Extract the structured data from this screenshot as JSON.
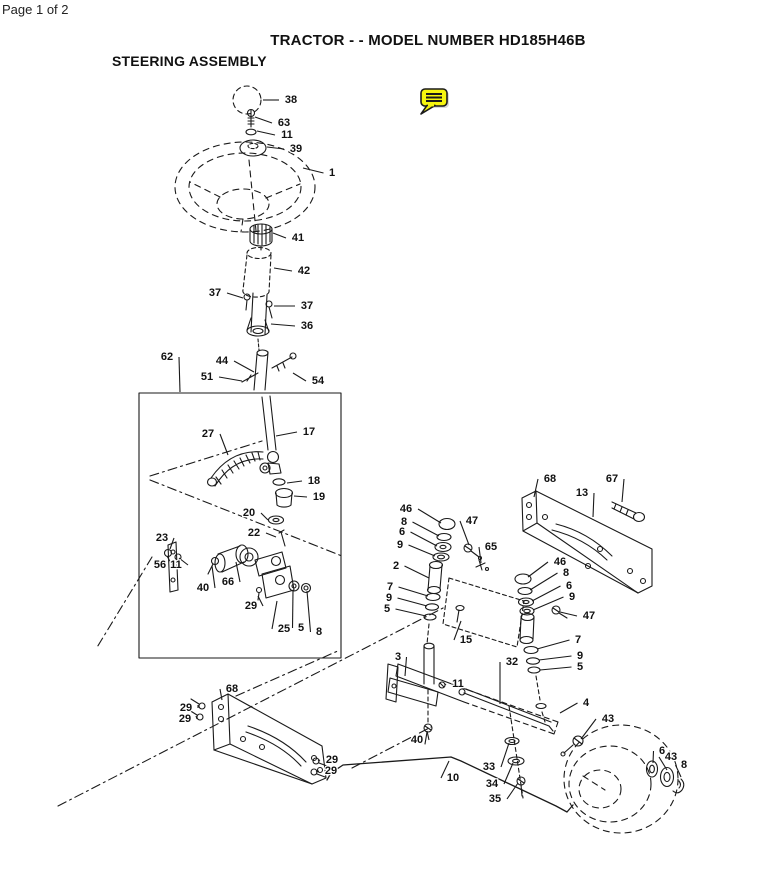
{
  "page": {
    "indicator": "Page 1 of 2"
  },
  "header": {
    "title": "TRACTOR - - MODEL NUMBER HD185H46B",
    "subtitle": "STEERING ASSEMBLY"
  },
  "annotation": {
    "icon": "comment-note",
    "color": "#f6f50e"
  },
  "diagram": {
    "description": "Exploded parts view of tractor steering assembly with numbered callouts",
    "ink": "#1a1a1a",
    "callouts": [
      {
        "n": "38",
        "x": 291,
        "y": 100,
        "tx": 263,
        "ty": 100
      },
      {
        "n": "63",
        "x": 284,
        "y": 123,
        "tx": 255,
        "ty": 117
      },
      {
        "n": "11",
        "x": 287,
        "y": 135,
        "tx": 257,
        "ty": 131
      },
      {
        "n": "39",
        "x": 296,
        "y": 149,
        "tx": 267,
        "ty": 147
      },
      {
        "n": "1",
        "x": 332,
        "y": 173,
        "tx": 303,
        "ty": 168
      },
      {
        "n": "41",
        "x": 298,
        "y": 238,
        "tx": 273,
        "ty": 233
      },
      {
        "n": "42",
        "x": 304,
        "y": 271,
        "tx": 274,
        "ty": 268
      },
      {
        "n": "37",
        "x": 215,
        "y": 293,
        "tx": 243,
        "ty": 298
      },
      {
        "n": "37",
        "x": 307,
        "y": 306,
        "tx": 274,
        "ty": 306
      },
      {
        "n": "36",
        "x": 307,
        "y": 326,
        "tx": 271,
        "ty": 324
      },
      {
        "n": "62",
        "x": 167,
        "y": 357,
        "tx": 180,
        "ty": 392
      },
      {
        "n": "44",
        "x": 222,
        "y": 361,
        "tx": 254,
        "ty": 372
      },
      {
        "n": "51",
        "x": 207,
        "y": 377,
        "tx": 242,
        "ty": 381
      },
      {
        "n": "54",
        "x": 318,
        "y": 381,
        "tx": 293,
        "ty": 373
      },
      {
        "n": "17",
        "x": 309,
        "y": 432,
        "tx": 276,
        "ty": 436
      },
      {
        "n": "27",
        "x": 208,
        "y": 434,
        "tx": 228,
        "ty": 455
      },
      {
        "n": "18",
        "x": 314,
        "y": 481,
        "tx": 287,
        "ty": 483
      },
      {
        "n": "19",
        "x": 319,
        "y": 497,
        "tx": 294,
        "ty": 496
      },
      {
        "n": "20",
        "x": 249,
        "y": 513,
        "tx": 268,
        "ty": 520
      },
      {
        "n": "22",
        "x": 254,
        "y": 533,
        "tx": 276,
        "ty": 537
      },
      {
        "n": "23",
        "x": 162,
        "y": 538,
        "tx": 170,
        "ty": 549
      },
      {
        "n": "56",
        "x": 160,
        "y": 565,
        "tx": 167,
        "ty": 556
      },
      {
        "n": "11",
        "x": 176,
        "y": 565,
        "tx": 179,
        "ty": 558
      },
      {
        "n": "40",
        "x": 203,
        "y": 588,
        "tx": 212,
        "ty": 566
      },
      {
        "n": "66",
        "x": 228,
        "y": 582,
        "tx": 236,
        "ty": 562
      },
      {
        "n": "29",
        "x": 251,
        "y": 606,
        "tx": 258,
        "ty": 596
      },
      {
        "n": "25",
        "x": 284,
        "y": 629,
        "tx": 277,
        "ty": 601
      },
      {
        "n": "5",
        "x": 301,
        "y": 628,
        "tx": 293,
        "ty": 591
      },
      {
        "n": "8",
        "x": 319,
        "y": 632,
        "tx": 307,
        "ty": 591
      },
      {
        "n": "68",
        "x": 550,
        "y": 479,
        "tx": 534,
        "ty": 497
      },
      {
        "n": "13",
        "x": 582,
        "y": 493,
        "tx": 593,
        "ty": 517
      },
      {
        "n": "67",
        "x": 612,
        "y": 479,
        "tx": 622,
        "ty": 502
      },
      {
        "n": "46",
        "x": 406,
        "y": 509,
        "tx": 441,
        "ty": 523
      },
      {
        "n": "8",
        "x": 404,
        "y": 522,
        "tx": 439,
        "ty": 536
      },
      {
        "n": "6",
        "x": 402,
        "y": 532,
        "tx": 437,
        "ty": 546
      },
      {
        "n": "9",
        "x": 400,
        "y": 545,
        "tx": 435,
        "ty": 556
      },
      {
        "n": "47",
        "x": 472,
        "y": 521,
        "tx": 469,
        "ty": 545
      },
      {
        "n": "65",
        "x": 491,
        "y": 547,
        "tx": 481,
        "ty": 563
      },
      {
        "n": "2",
        "x": 396,
        "y": 566,
        "tx": 429,
        "ty": 578
      },
      {
        "n": "7",
        "x": 390,
        "y": 587,
        "tx": 428,
        "ty": 596
      },
      {
        "n": "9",
        "x": 389,
        "y": 598,
        "tx": 427,
        "ty": 606
      },
      {
        "n": "5",
        "x": 387,
        "y": 609,
        "tx": 426,
        "ty": 616
      },
      {
        "n": "15",
        "x": 466,
        "y": 640,
        "tx": 461,
        "ty": 621
      },
      {
        "n": "46",
        "x": 560,
        "y": 562,
        "tx": 528,
        "ty": 577
      },
      {
        "n": "8",
        "x": 566,
        "y": 573,
        "tx": 530,
        "ty": 590
      },
      {
        "n": "6",
        "x": 569,
        "y": 586,
        "tx": 532,
        "ty": 601
      },
      {
        "n": "9",
        "x": 572,
        "y": 597,
        "tx": 533,
        "ty": 610
      },
      {
        "n": "47",
        "x": 589,
        "y": 616,
        "tx": 560,
        "ty": 612
      },
      {
        "n": "7",
        "x": 578,
        "y": 640,
        "tx": 537,
        "ty": 649
      },
      {
        "n": "9",
        "x": 580,
        "y": 656,
        "tx": 539,
        "ty": 660
      },
      {
        "n": "5",
        "x": 580,
        "y": 667,
        "tx": 540,
        "ty": 670
      },
      {
        "n": "3",
        "x": 398,
        "y": 657,
        "tx": 405,
        "ty": 676
      },
      {
        "n": "32",
        "x": 512,
        "y": 662,
        "tx": 500,
        "ty": 704
      },
      {
        "n": "11",
        "x": 458,
        "y": 684,
        "tx": 445,
        "ty": 685
      },
      {
        "n": "4",
        "x": 586,
        "y": 703,
        "tx": 560,
        "ty": 713
      },
      {
        "n": "43",
        "x": 608,
        "y": 719,
        "tx": 581,
        "ty": 739
      },
      {
        "n": "68",
        "x": 232,
        "y": 689,
        "tx": 222,
        "ty": 700
      },
      {
        "n": "29",
        "x": 186,
        "y": 708,
        "tx": 198,
        "ty": 705
      },
      {
        "n": "29",
        "x": 185,
        "y": 719,
        "tx": 196,
        "ty": 716
      },
      {
        "n": "29",
        "x": 332,
        "y": 760,
        "tx": 318,
        "ty": 761
      },
      {
        "n": "29",
        "x": 331,
        "y": 771,
        "tx": 316,
        "ty": 772
      },
      {
        "n": "40",
        "x": 417,
        "y": 740,
        "tx": 427,
        "ty": 731
      },
      {
        "n": "10",
        "x": 453,
        "y": 778,
        "tx": 449,
        "ty": 761
      },
      {
        "n": "33",
        "x": 489,
        "y": 767,
        "tx": 509,
        "ty": 743
      },
      {
        "n": "34",
        "x": 492,
        "y": 784,
        "tx": 513,
        "ty": 763
      },
      {
        "n": "35",
        "x": 495,
        "y": 799,
        "tx": 518,
        "ty": 783
      },
      {
        "n": "6",
        "x": 662,
        "y": 751,
        "tx": 653,
        "ty": 763
      },
      {
        "n": "43",
        "x": 671,
        "y": 757,
        "tx": 667,
        "ty": 770
      },
      {
        "n": "8",
        "x": 684,
        "y": 765,
        "tx": 681,
        "ty": 777
      }
    ]
  }
}
